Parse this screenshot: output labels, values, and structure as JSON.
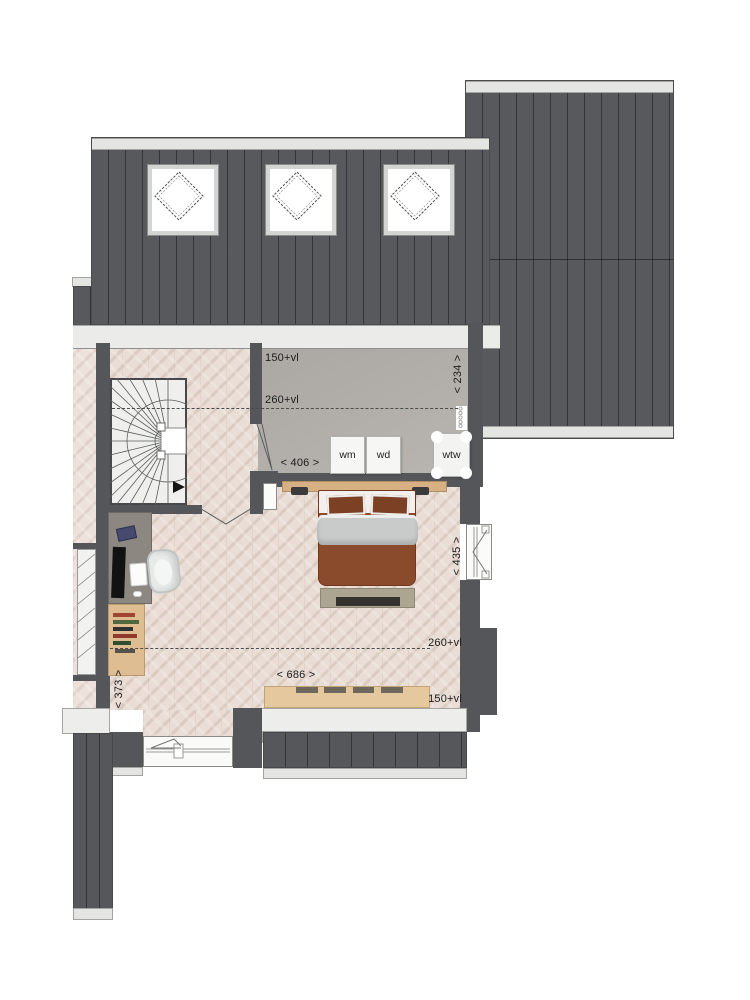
{
  "plan": {
    "dimension_labels": {
      "tech_knee_wall": "150+vl",
      "tech_headroom": "260+vl",
      "tech_width": "< 406 >",
      "tech_depth": "< 234 >",
      "bedroom_depth": "< 435 >",
      "bedroom_headroom": "260+vl",
      "bedroom_width": "< 686 >",
      "bedroom_knee_wall": "150+vl",
      "landing_width": "< 373 >"
    },
    "appliances": {
      "washing_machine": "wm",
      "dryer": "wd",
      "heat_recovery_unit": "wtw"
    },
    "colors": {
      "roof_dark": "#57595c",
      "roof_trim": "#e4e4e2",
      "wall": "#54565a",
      "parquet_floor": "#e9ddd5",
      "concrete_floor": "#b4b1ac",
      "wood_light": "#dfbd92",
      "bed_brown": "#8a4a2c",
      "blanket_gray": "#c9cbca"
    },
    "features": [
      "main-roof",
      "dormer-roof",
      "skylights",
      "spiral-stairs",
      "double-bed",
      "desk",
      "office-chair",
      "bookshelf",
      "sideboard",
      "side-window",
      "bottom-window",
      "ventilation-grille"
    ]
  }
}
